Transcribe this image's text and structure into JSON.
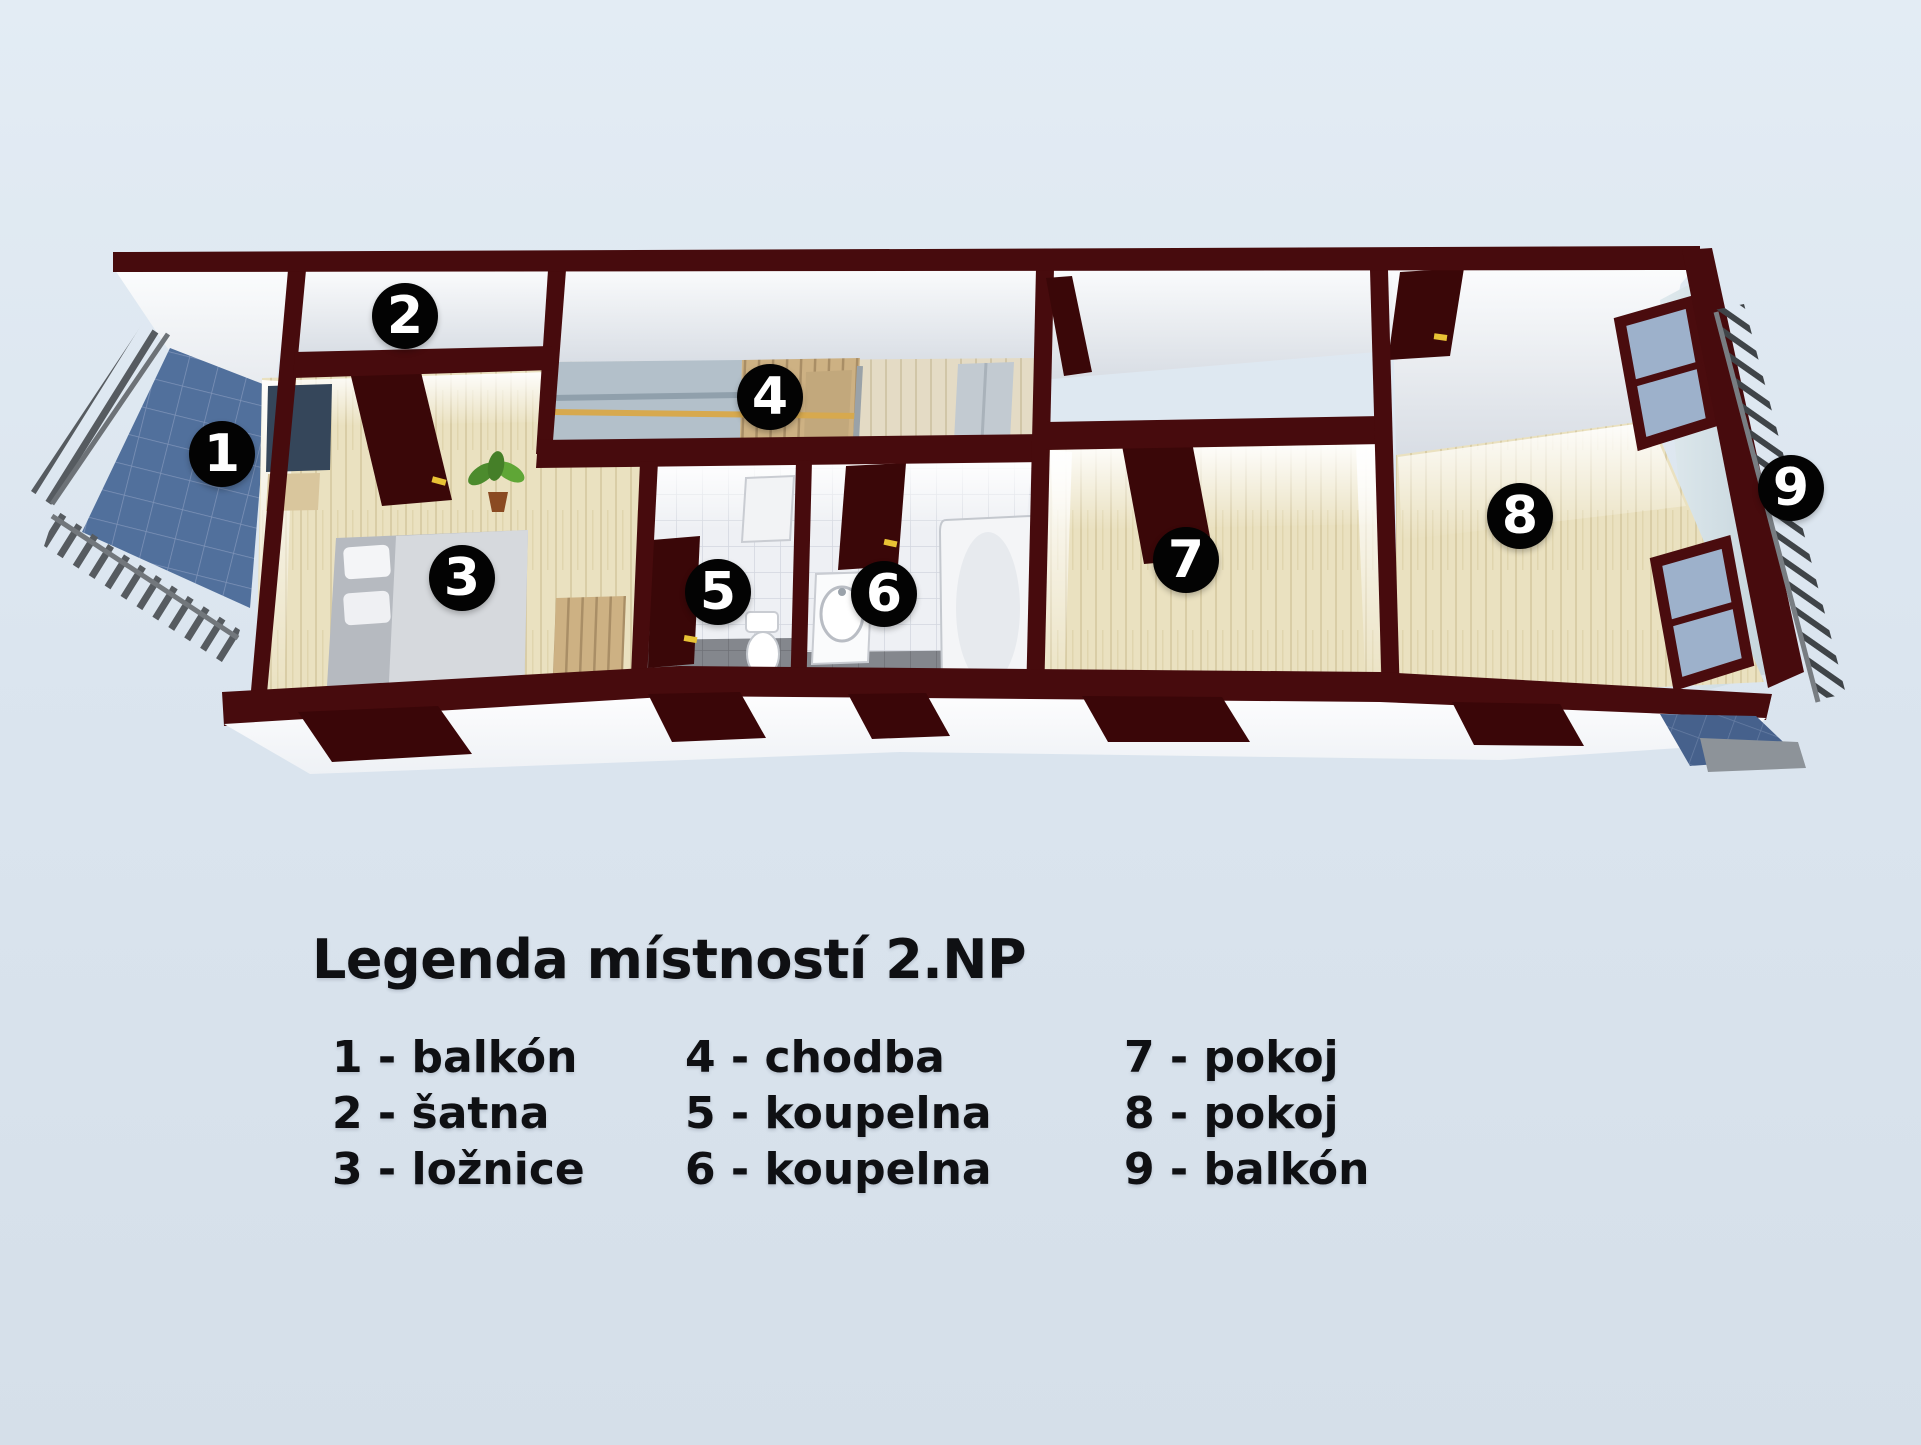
{
  "plan": {
    "floor_label": "2.NP",
    "rooms": [
      {
        "number": "1",
        "name": "balkón"
      },
      {
        "number": "2",
        "name": "šatna"
      },
      {
        "number": "3",
        "name": "ložnice"
      },
      {
        "number": "4",
        "name": "chodba"
      },
      {
        "number": "5",
        "name": "koupelna"
      },
      {
        "number": "6",
        "name": "koupelna"
      },
      {
        "number": "7",
        "name": "pokoj"
      },
      {
        "number": "8",
        "name": "pokoj"
      },
      {
        "number": "9",
        "name": "balkón"
      }
    ],
    "markers": [
      "1",
      "2",
      "3",
      "4",
      "5",
      "6",
      "7",
      "8",
      "9"
    ],
    "colors": {
      "background": "#dce6f0",
      "wall": "#470b0d",
      "door": "#3a0708",
      "door_handle": "#e8c235",
      "wood_floor": "#e9dfbe",
      "hall_floor": "#e3dac4",
      "tile_floor": "#eef0f4",
      "tile_floor_dark": "#85888d",
      "balcony_tile": "#51709c",
      "railing": "#565b60",
      "window_glass": "#9db1cb",
      "marker_bg": "#030303",
      "marker_text": "#ffffff",
      "text": "#0f1013"
    }
  },
  "legend": {
    "title": "Legenda místností 2.NP",
    "columns": [
      {
        "rows": [
          "1 - balkón",
          "2 - šatna",
          "3 - ložnice"
        ]
      },
      {
        "rows": [
          "4 - chodba",
          "5 - koupelna",
          "6 - koupelna"
        ]
      },
      {
        "rows": [
          "7 - pokoj",
          "8 - pokoj",
          "9 - balkón"
        ]
      }
    ]
  }
}
